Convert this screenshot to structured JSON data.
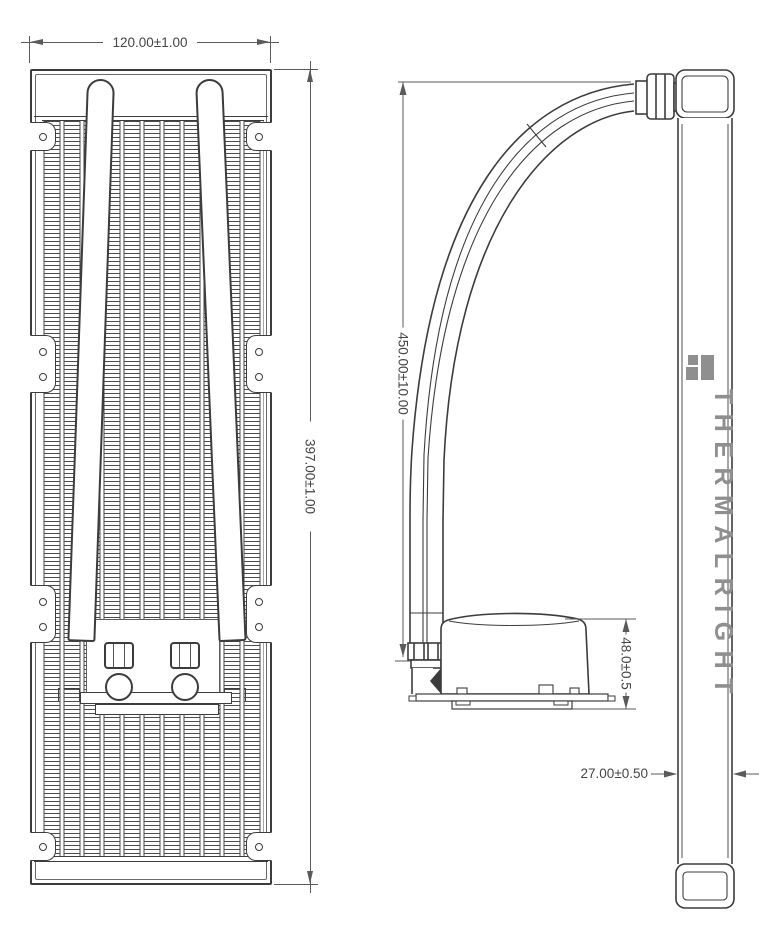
{
  "drawing": {
    "type": "AIO liquid cooler dimensional drawing",
    "views": {
      "front": "radiator front view",
      "side": "radiator side view with tube and pump"
    }
  },
  "brand": {
    "name": "THERMALRIGHT",
    "logo": "thermalright-quadrant-logo",
    "color": "#8f8f8f"
  },
  "dimensions": {
    "radiator_width": "120.00±1.00",
    "radiator_length": "397.00±1.00",
    "tube_length": "450.00±10.00",
    "pump_height": "48.0±0.5",
    "radiator_thickness": "27.00±0.50"
  },
  "colors": {
    "outline": "#3c3c3c",
    "dimension_lines": "#5a5a5a",
    "background": "#ffffff"
  }
}
